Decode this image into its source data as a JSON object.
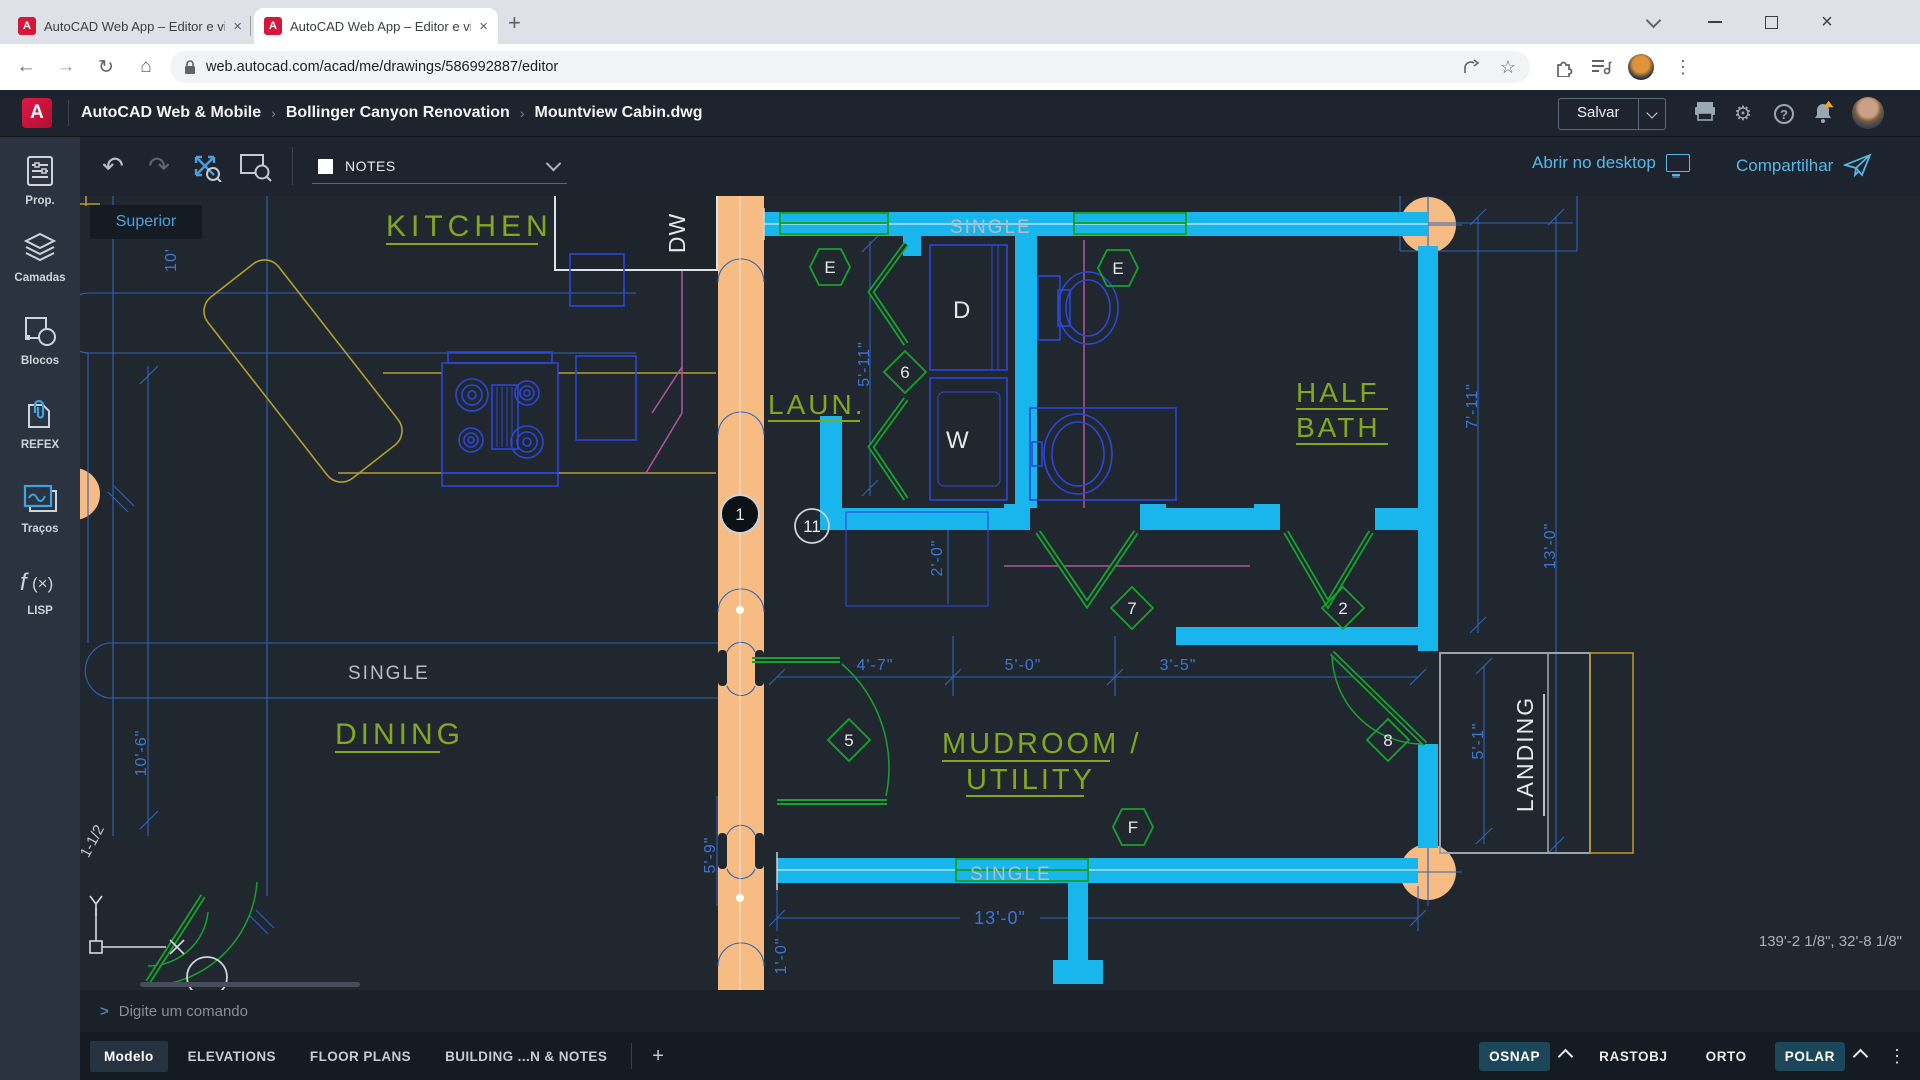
{
  "browser": {
    "tab1_title": "AutoCAD Web App – Editor e vis",
    "tab2_title": "AutoCAD Web App – Editor e vis",
    "favicon_letter": "A",
    "url": "web.autocad.com/acad/me/drawings/586992887/editor"
  },
  "header": {
    "logo_letter": "A",
    "breadcrumb1": "AutoCAD Web & Mobile",
    "breadcrumb2": "Bollinger Canyon Renovation",
    "breadcrumb3": "Mountview Cabin.dwg",
    "save_label": "Salvar"
  },
  "toolbar": {
    "layer_name": "NOTES",
    "open_desktop_label": "Abrir no desktop",
    "share_label": "Compartilhar",
    "tooltip": "Superior"
  },
  "sidebar": {
    "item1": "Prop.",
    "item2": "Camadas",
    "item3": "Blocos",
    "item4": "REFEX",
    "item5": "Traços",
    "item6": "LISP"
  },
  "plan": {
    "rooms": {
      "kitchen": "KITCHEN",
      "laundry": "LAUN.",
      "half1": "HALF",
      "half2": "BATH",
      "dining": "DINING",
      "mud1": "MUDROOM /",
      "mud2": "UTILITY",
      "landing": "LANDING"
    },
    "labels": {
      "window": "SINGLE",
      "dw": "DW",
      "dryer": "D",
      "washer": "W"
    },
    "tags": {
      "t1": "1",
      "t11": "11",
      "e": "E",
      "n6": "6",
      "n7": "7",
      "n2": "2",
      "n5": "5",
      "n8": "8",
      "f": "F"
    },
    "dims": {
      "top_left": "10'",
      "left": "10'-6\"",
      "laun": "5'-11\"",
      "closet": "2'-0\"",
      "mud_a": "4'-7\"",
      "mud_b": "5'-0\"",
      "mud_c": "3'-5\"",
      "right_upper": "7'-11\"",
      "right_full": "13'-0\"",
      "bottom": "13'-0\"",
      "mud_left": "5'-9\"",
      "landing": "5'-1\"",
      "small": "1'-0\"",
      "note": "1-1/2"
    }
  },
  "statusbar": {
    "coords": "139'-2 1/8\", 32'-8 1/8\""
  },
  "bottombar": {
    "command_placeholder": "Digite um comando",
    "tab1": "Modelo",
    "tab2": "ELEVATIONS",
    "tab3": "FLOOR PLANS",
    "tab4": "BUILDING ...N & NOTES",
    "toggle1": "OSNAP",
    "toggle2": "RASTOBJ",
    "toggle3": "ORTO",
    "toggle4": "POLAR"
  }
}
